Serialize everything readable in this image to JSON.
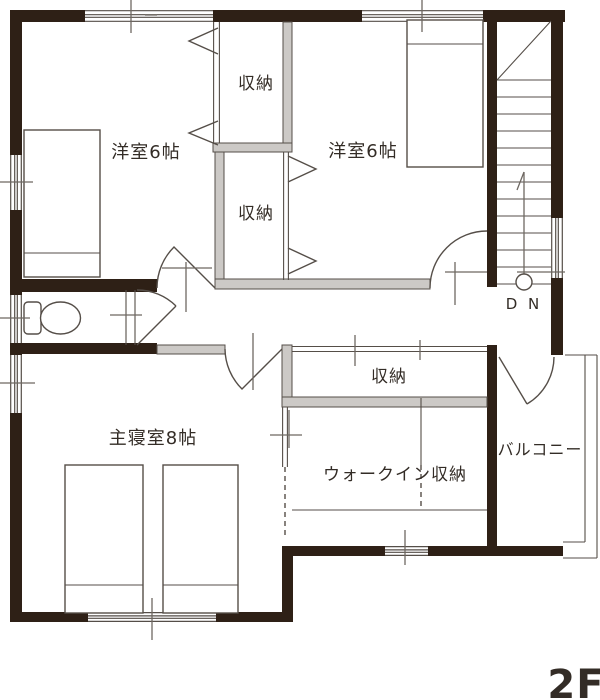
{
  "floor_plan": {
    "floor_label": "2F",
    "stairs": {
      "direction_label": "D N"
    },
    "rooms": {
      "western_room_1": {
        "label": "洋室6帖"
      },
      "western_room_2": {
        "label": "洋室6帖"
      },
      "closet_upper": {
        "label": "収納"
      },
      "closet_lower": {
        "label": "収納"
      },
      "hall_storage": {
        "label": "収納"
      },
      "walk_in_closet": {
        "label": "ウォークイン収納"
      },
      "master_bedroom": {
        "label": "主寝室8帖"
      },
      "balcony": {
        "label": "バルコニー"
      }
    }
  },
  "colors": {
    "wall_black": "#2e2016",
    "wall_light": "#ccc9c6",
    "line_dark": "#554e48",
    "tick": "#6e6862",
    "text": "#332c26"
  }
}
